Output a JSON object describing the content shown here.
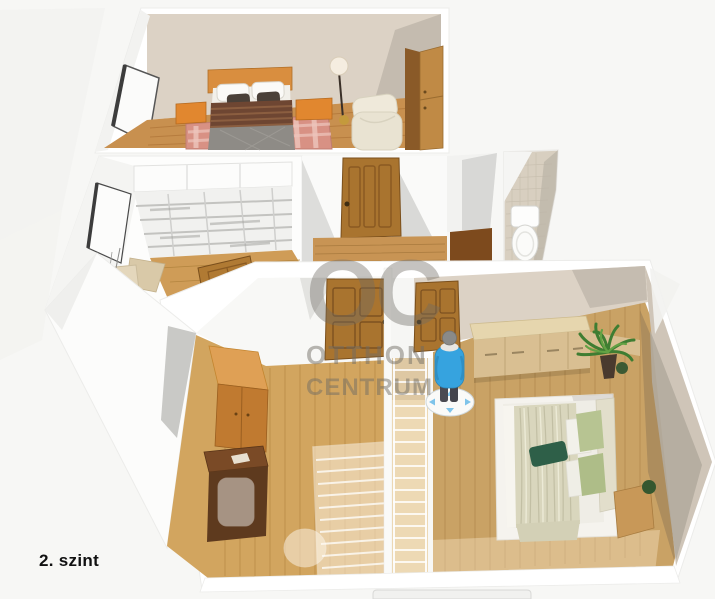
{
  "page": {
    "type": "3d-floor-plan-render",
    "floor_label": "2. szint"
  },
  "watermark": {
    "logo": "OC",
    "line1": "OTTHON",
    "line2": "CENTRUM"
  },
  "palette": {
    "background": "#F6F6F4",
    "wall_beige": "#DCD2C5",
    "wall_beige_shadow": "#BFB7AA",
    "wall_white": "#F8F8F6",
    "wall_white_shadow": "#D9D9D7",
    "tile_beige": "#D8CFC0",
    "floor_wood": "#C8904F",
    "floor_wood_light": "#D2A55F",
    "floor_master": "#C9A265",
    "stairs_translucent": "#EBD5AC",
    "door_wood": "#A9742F",
    "wardrobe_orange": "#C07A30",
    "bed_headboard_orange": "#D98E3F",
    "bed_blanket_brown": "#6E4632",
    "bed_quilt_grey": "#8E8B86",
    "rug_pink": "#D89184",
    "bed_blanket_sage": "#D9D6BD",
    "pillow_dark_green": "#2E5F48",
    "pillow_light_green": "#B7C492",
    "plant_green": "#3F7D32",
    "avatar_blue": "#36A3DF",
    "watermark_grey": "#6F6B64",
    "label_black": "#111111"
  },
  "scene": {
    "levels_visible": 1,
    "rooms": [
      {
        "name": "bedroom-upper",
        "furniture": [
          "double-bed",
          "nightstand-left",
          "nightstand-right",
          "floor-lamp",
          "armchair",
          "wardrobe",
          "checkered-rug",
          "window"
        ]
      },
      {
        "name": "study",
        "furniture": [
          "bookshelf",
          "desk",
          "chair",
          "window"
        ]
      },
      {
        "name": "hallway",
        "furniture": [
          "wood-door-closed",
          "wood-door-open"
        ]
      },
      {
        "name": "wc",
        "furniture": [
          "toilet"
        ]
      },
      {
        "name": "stair-room",
        "furniture": [
          "wardrobe",
          "desk",
          "ghost-chair",
          "staircase-translucent"
        ]
      },
      {
        "name": "master-bedroom",
        "furniture": [
          "double-bed",
          "sideboard",
          "potted-plant",
          "nightstand",
          "wood-door-closed",
          "person-avatar"
        ]
      }
    ]
  }
}
